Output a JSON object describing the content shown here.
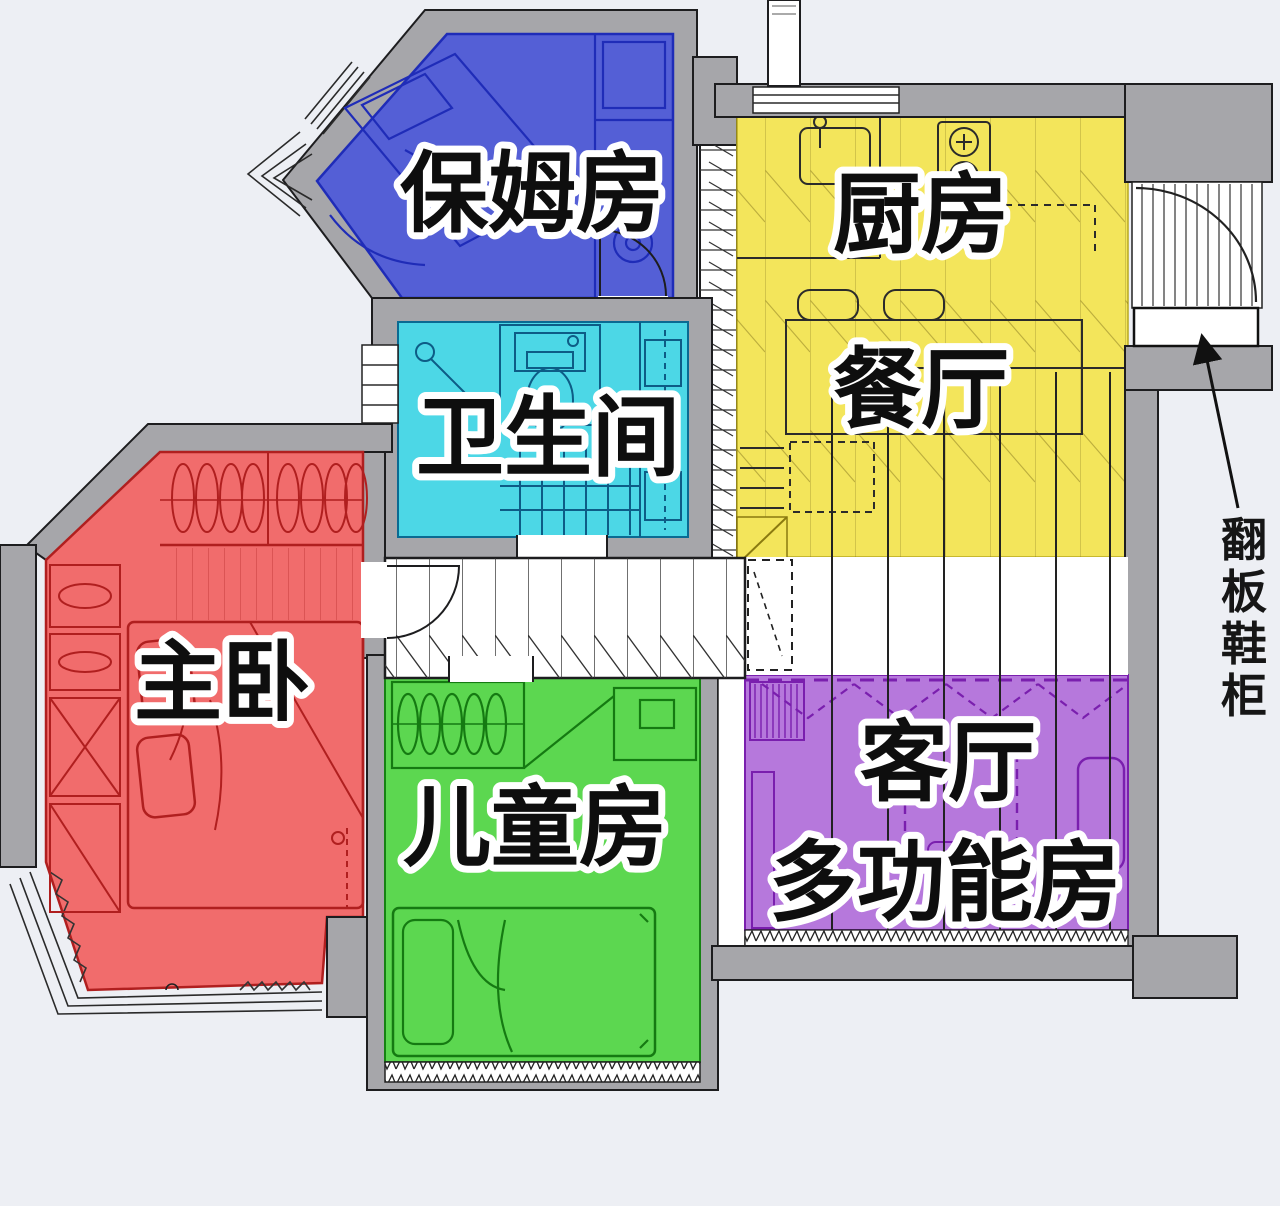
{
  "floorplan": {
    "type": "apartment-floor-plan",
    "rooms": [
      {
        "key": "nanny-room",
        "label": "保姆房",
        "color": "#545fd6"
      },
      {
        "key": "kitchen",
        "label": "厨房",
        "color": "#f3e55b"
      },
      {
        "key": "dining-room",
        "label": "餐厅",
        "color": "#f3e55b"
      },
      {
        "key": "bathroom",
        "label": "卫生间",
        "color": "#4cd7e6"
      },
      {
        "key": "master-bedroom",
        "label": "主卧",
        "color": "#f16c6c"
      },
      {
        "key": "kids-room",
        "label": "儿童房",
        "color": "#5cd750"
      },
      {
        "key": "living-room",
        "label": "客厅",
        "color": "#b678dc"
      },
      {
        "key": "multi-function",
        "label": "多功能房",
        "color": "#b678dc"
      }
    ],
    "annotation": {
      "label": "翻板鞋柜",
      "chars": [
        "翻",
        "板",
        "鞋",
        "柜"
      ]
    },
    "colors": {
      "wall": "#a6a6aa",
      "background": "#edeff4",
      "corridor": "#ffffff",
      "label_fill": "#0e0e0e",
      "label_outline": "#ffffff"
    }
  }
}
